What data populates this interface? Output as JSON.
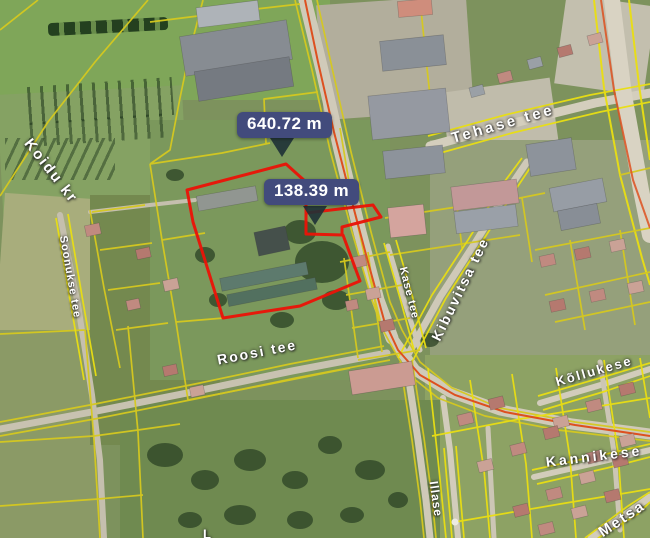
{
  "map": {
    "measurements": [
      {
        "value": "640.72 m"
      },
      {
        "value": "138.39 m"
      }
    ],
    "street_labels": [
      {
        "id": "tehase",
        "text": "Tehase tee"
      },
      {
        "id": "kibuvitsa",
        "text": "Kibuvitsa tee"
      },
      {
        "id": "kase",
        "text": "Kase tee"
      },
      {
        "id": "roosi",
        "text": "Roosi tee"
      },
      {
        "id": "kollukese",
        "text": "Kõllukese"
      },
      {
        "id": "kannikese",
        "text": "Kannikese"
      },
      {
        "id": "illase",
        "text": "Illase"
      },
      {
        "id": "metsa",
        "text": "Metsa"
      },
      {
        "id": "koidu",
        "text": "Koidu kr"
      },
      {
        "id": "soonukse",
        "text": "Soonukse tee"
      },
      {
        "id": "edge-cut",
        "text": "L"
      }
    ],
    "colors": {
      "cadastral_line": "#d6c91f",
      "cadastral_line_bright": "#eadf12",
      "selected_parcel_outline": "#ea1408",
      "road_axis": "#dd5020",
      "measure_badge_bg": "#424b7c",
      "measure_pointer": "#1e3136",
      "label_text": "#ffffff"
    }
  }
}
